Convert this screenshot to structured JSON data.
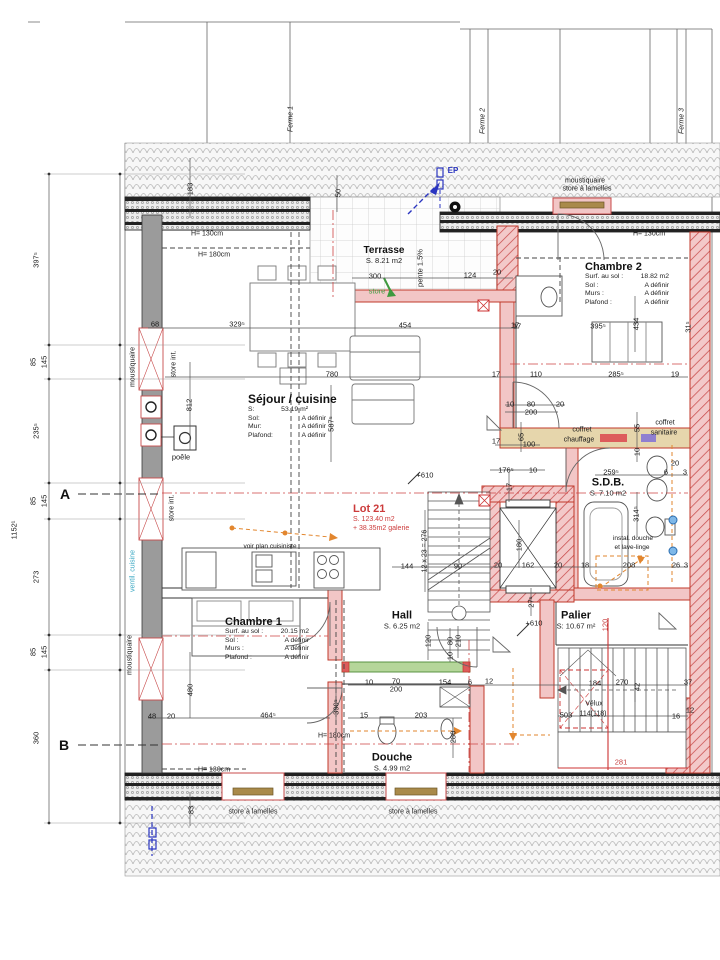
{
  "rooms": {
    "terrasse": {
      "name": "Terrasse",
      "area": "S. 8.21 m2"
    },
    "chambre2": {
      "name": "Chambre 2",
      "lines": [
        [
          "Surf. au sol :",
          "18.82 m2"
        ],
        [
          "Sol :",
          "A définir"
        ],
        [
          "Murs :",
          "A définir"
        ],
        [
          "Plafond :",
          "A définir"
        ]
      ]
    },
    "sejour": {
      "name": "Séjour / cuisine",
      "lines": [
        [
          "S:",
          "53.19 m²"
        ],
        [
          "Sol:",
          "A définir"
        ],
        [
          "Mur:",
          "A définir"
        ],
        [
          "Plafond:",
          "A définir"
        ]
      ]
    },
    "sdb": {
      "name": "S.D.B.",
      "area": "S. 7.10 m2"
    },
    "hall": {
      "name": "Hall",
      "area": "S. 6.25 m2"
    },
    "palier": {
      "name": "Palier",
      "area": "S: 10.67 m²"
    },
    "chambre1": {
      "name": "Chambre 1",
      "lines": [
        [
          "Surf. au sol :",
          "20.15 m2"
        ],
        [
          "Sol :",
          "A définir"
        ],
        [
          "Murs :",
          "A définir"
        ],
        [
          "Plafond :",
          "A définir"
        ]
      ]
    },
    "douche": {
      "name": "Douche",
      "area": "S. 4.99 m2"
    }
  },
  "lot": {
    "title": "Lot 21",
    "line1": "S. 123.40 m2",
    "line2": "+ 38.35m2 galerie"
  },
  "grid": {
    "row_a": "A",
    "row_b": "B"
  },
  "colors": {
    "wall_red": "#c0392b",
    "wall_pink": "#f2c6c6",
    "wall_gray": "#9b9b9b",
    "accent_orange": "#e2862e",
    "accent_green": "#3f9a3f",
    "accent_blue": "#2a35c0",
    "accent_cyan": "#38a7c2",
    "coffret_red": "#dd5c5c",
    "coffret_purple": "#8f7fd0"
  },
  "annotations": [
    {
      "t": "moustiquaire",
      "x": 585,
      "y": 181,
      "s": 7
    },
    {
      "t": "store à lamelles",
      "x": 587,
      "y": 189,
      "s": 7
    },
    {
      "t": "EP",
      "x": 453,
      "y": 171,
      "c": "blue",
      "s": 8,
      "b": 1
    },
    {
      "t": "H= 130cm",
      "x": 207,
      "y": 234,
      "s": 7
    },
    {
      "t": "H= 180cm",
      "x": 214,
      "y": 255,
      "s": 7
    },
    {
      "t": "H= 130cm",
      "x": 649,
      "y": 234,
      "s": 7
    },
    {
      "t": "H= 130cm",
      "x": 214,
      "y": 770,
      "s": 7
    },
    {
      "t": "H= 180cm",
      "x": 334,
      "y": 736,
      "s": 7
    },
    {
      "t": "pente 1.5%",
      "x": 420,
      "y": 268,
      "r": -90,
      "s": 7.5
    },
    {
      "t": "store",
      "x": 377,
      "y": 291,
      "c": "green",
      "s": 7.5
    },
    {
      "t": "moustiquaire",
      "x": 133,
      "y": 367,
      "r": -90,
      "s": 7
    },
    {
      "t": "store int.",
      "x": 174,
      "y": 364,
      "r": -90,
      "s": 7
    },
    {
      "t": "store int.",
      "x": 172,
      "y": 508,
      "r": -90,
      "s": 7
    },
    {
      "t": "ventil. cuisine",
      "x": 133,
      "y": 571,
      "r": -90,
      "c": "cyan",
      "s": 7
    },
    {
      "t": "moustiquaire",
      "x": 130,
      "y": 655,
      "r": -90,
      "s": 7
    },
    {
      "t": "poêle",
      "x": 181,
      "y": 457,
      "s": 7.5
    },
    {
      "t": "voir plan cuisiniste",
      "x": 270,
      "y": 547,
      "s": 6.5
    },
    {
      "t": "coffret",
      "x": 582,
      "y": 430,
      "s": 7
    },
    {
      "t": "chauffage",
      "x": 579,
      "y": 440,
      "s": 7
    },
    {
      "t": "coffret",
      "x": 665,
      "y": 423,
      "s": 7
    },
    {
      "t": "sanitaire",
      "x": 664,
      "y": 433,
      "s": 7
    },
    {
      "t": "instal. douche",
      "x": 633,
      "y": 539,
      "s": 6.5
    },
    {
      "t": "et lave-linge",
      "x": 632,
      "y": 548,
      "s": 6.5
    },
    {
      "t": "store à lamelles",
      "x": 253,
      "y": 812,
      "s": 7
    },
    {
      "t": "store à lamelles",
      "x": 413,
      "y": 812,
      "s": 7
    },
    {
      "t": "Vélux",
      "x": 594,
      "y": 704,
      "s": 7
    },
    {
      "t": "114(118)",
      "x": 593,
      "y": 714,
      "s": 7
    },
    {
      "t": "12 x 23 = 276",
      "x": 425,
      "y": 551,
      "r": -90,
      "s": 7
    },
    {
      "t": "+610",
      "x": 425,
      "y": 475,
      "s": 7.5
    },
    {
      "t": "+610",
      "x": 534,
      "y": 623,
      "s": 7.5
    },
    {
      "t": "Ferme 1",
      "x": 291,
      "y": 119,
      "r": -90,
      "i": 1,
      "s": 7
    },
    {
      "t": "Ferme 2",
      "x": 483,
      "y": 121,
      "r": -90,
      "i": 1,
      "s": 7
    },
    {
      "t": "Ferme 3",
      "x": 682,
      "y": 121,
      "r": -90,
      "i": 1,
      "s": 7
    }
  ],
  "dimensions": [
    {
      "t": "397⁵",
      "x": 36,
      "y": 260,
      "r": -90
    },
    {
      "t": "85",
      "x": 33,
      "y": 362,
      "r": -90
    },
    {
      "t": "145",
      "x": 44,
      "y": 362,
      "r": -90
    },
    {
      "t": "235⁵",
      "x": 36,
      "y": 431,
      "r": -90
    },
    {
      "t": "1152¹",
      "x": 14,
      "y": 530,
      "r": -90
    },
    {
      "t": "85",
      "x": 33,
      "y": 501,
      "r": -90
    },
    {
      "t": "145",
      "x": 44,
      "y": 501,
      "r": -90
    },
    {
      "t": "273",
      "x": 36,
      "y": 577,
      "r": -90
    },
    {
      "t": "85",
      "x": 33,
      "y": 652,
      "r": -90
    },
    {
      "t": "145",
      "x": 44,
      "y": 652,
      "r": -90
    },
    {
      "t": "360",
      "x": 36,
      "y": 738,
      "r": -90
    },
    {
      "t": "183",
      "x": 190,
      "y": 189,
      "r": -90
    },
    {
      "t": "50",
      "x": 338,
      "y": 193,
      "r": -90
    },
    {
      "t": "300",
      "x": 375,
      "y": 276
    },
    {
      "t": "124",
      "x": 470,
      "y": 275
    },
    {
      "t": "20",
      "x": 497,
      "y": 272
    },
    {
      "t": "68",
      "x": 155,
      "y": 324
    },
    {
      "t": "329⁵",
      "x": 237,
      "y": 324
    },
    {
      "t": "454",
      "x": 405,
      "y": 325
    },
    {
      "t": "17",
      "x": 515,
      "y": 325
    },
    {
      "t": "780",
      "x": 332,
      "y": 374
    },
    {
      "t": "812",
      "x": 189,
      "y": 405,
      "r": -90
    },
    {
      "t": "587⁵",
      "x": 331,
      "y": 424,
      "r": -90
    },
    {
      "t": "395⁵",
      "x": 598,
      "y": 326
    },
    {
      "t": "434",
      "x": 636,
      "y": 324,
      "r": -90
    },
    {
      "t": "31⁵",
      "x": 688,
      "y": 327,
      "r": -90
    },
    {
      "t": "17",
      "x": 517,
      "y": 326
    },
    {
      "t": "17",
      "x": 496,
      "y": 374
    },
    {
      "t": "110",
      "x": 536,
      "y": 374
    },
    {
      "t": "285⁵",
      "x": 616,
      "y": 374
    },
    {
      "t": "19",
      "x": 675,
      "y": 374
    },
    {
      "t": "10",
      "x": 510,
      "y": 404
    },
    {
      "t": "80",
      "x": 531,
      "y": 404
    },
    {
      "t": "20",
      "x": 560,
      "y": 404
    },
    {
      "t": "200",
      "x": 531,
      "y": 412
    },
    {
      "t": "65",
      "x": 521,
      "y": 437,
      "r": -90
    },
    {
      "t": "100",
      "x": 529,
      "y": 444
    },
    {
      "t": "17",
      "x": 496,
      "y": 441
    },
    {
      "t": "55",
      "x": 637,
      "y": 428,
      "r": -90
    },
    {
      "t": "10",
      "x": 637,
      "y": 452,
      "r": -90
    },
    {
      "t": "176⁵",
      "x": 506,
      "y": 470
    },
    {
      "t": "10",
      "x": 533,
      "y": 470
    },
    {
      "t": "259⁵",
      "x": 611,
      "y": 472
    },
    {
      "t": "20",
      "x": 675,
      "y": 463
    },
    {
      "t": "6",
      "x": 666,
      "y": 472
    },
    {
      "t": "3",
      "x": 685,
      "y": 472
    },
    {
      "t": "314⁵",
      "x": 636,
      "y": 514,
      "r": -90
    },
    {
      "t": "17",
      "x": 509,
      "y": 487,
      "r": -90
    },
    {
      "t": "180",
      "x": 519,
      "y": 545,
      "r": -90
    },
    {
      "t": "20",
      "x": 558,
      "y": 565
    },
    {
      "t": "18",
      "x": 585,
      "y": 565
    },
    {
      "t": "208",
      "x": 629,
      "y": 565
    },
    {
      "t": "26",
      "x": 676,
      "y": 565
    },
    {
      "t": "3",
      "x": 686,
      "y": 565
    },
    {
      "t": "144",
      "x": 407,
      "y": 566
    },
    {
      "t": "90",
      "x": 458,
      "y": 566
    },
    {
      "t": "20",
      "x": 498,
      "y": 565
    },
    {
      "t": "162",
      "x": 528,
      "y": 565
    },
    {
      "t": "27⁵",
      "x": 531,
      "y": 602,
      "r": -90
    },
    {
      "t": "120",
      "x": 428,
      "y": 641,
      "r": -90
    },
    {
      "t": "80",
      "x": 450,
      "y": 641,
      "r": -90
    },
    {
      "t": "210",
      "x": 458,
      "y": 641,
      "r": -90
    },
    {
      "t": "10",
      "x": 450,
      "y": 656,
      "r": -90
    },
    {
      "t": "10",
      "x": 369,
      "y": 682
    },
    {
      "t": "70",
      "x": 396,
      "y": 681
    },
    {
      "t": "200",
      "x": 396,
      "y": 689
    },
    {
      "t": "154",
      "x": 445,
      "y": 682
    },
    {
      "t": "6",
      "x": 470,
      "y": 682
    },
    {
      "t": "12",
      "x": 489,
      "y": 681
    },
    {
      "t": "184",
      "x": 595,
      "y": 683
    },
    {
      "t": "270",
      "x": 622,
      "y": 682
    },
    {
      "t": "42",
      "x": 637,
      "y": 687,
      "r": -90
    },
    {
      "t": "37",
      "x": 688,
      "y": 682
    },
    {
      "t": "503",
      "x": 566,
      "y": 715
    },
    {
      "t": "16",
      "x": 676,
      "y": 716
    },
    {
      "t": "12",
      "x": 690,
      "y": 710
    },
    {
      "t": "120",
      "x": 605,
      "y": 625,
      "r": -90,
      "c": "red"
    },
    {
      "t": "281",
      "x": 621,
      "y": 762,
      "c": "red"
    },
    {
      "t": "48",
      "x": 152,
      "y": 716
    },
    {
      "t": "20",
      "x": 171,
      "y": 716
    },
    {
      "t": "480",
      "x": 190,
      "y": 690,
      "r": -90
    },
    {
      "t": "464⁵",
      "x": 268,
      "y": 715
    },
    {
      "t": "390⁵",
      "x": 336,
      "y": 707,
      "r": -90
    },
    {
      "t": "15",
      "x": 364,
      "y": 715
    },
    {
      "t": "203",
      "x": 421,
      "y": 715
    },
    {
      "t": "280",
      "x": 453,
      "y": 737,
      "r": -90
    },
    {
      "t": "83",
      "x": 191,
      "y": 810,
      "r": -90
    }
  ]
}
